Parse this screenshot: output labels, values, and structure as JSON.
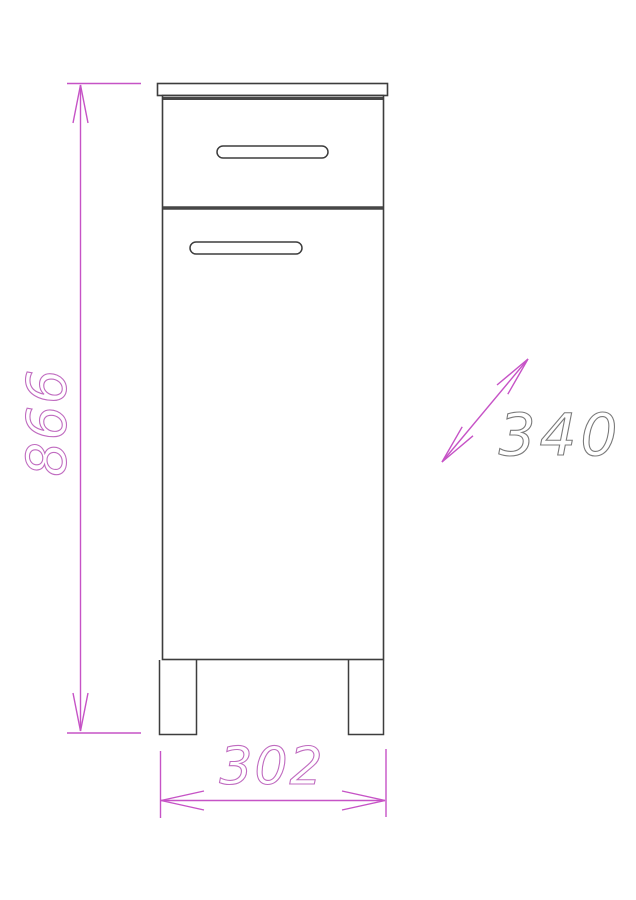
{
  "drawing": {
    "dimensions": {
      "height": {
        "value": "866",
        "orientation": "vertical-rotated"
      },
      "width": {
        "value": "302",
        "orientation": "horizontal"
      },
      "depth": {
        "value": "340",
        "orientation": "diagonal"
      }
    },
    "colors": {
      "dimension_line_magenta": "#c653c6",
      "dimension_text_magenta": "#c06cc0",
      "depth_text_gray": "#7b7b7b",
      "outline_dark": "#3d3d3d",
      "outline_thick_dark": "#474747",
      "background": "#ffffff"
    }
  }
}
